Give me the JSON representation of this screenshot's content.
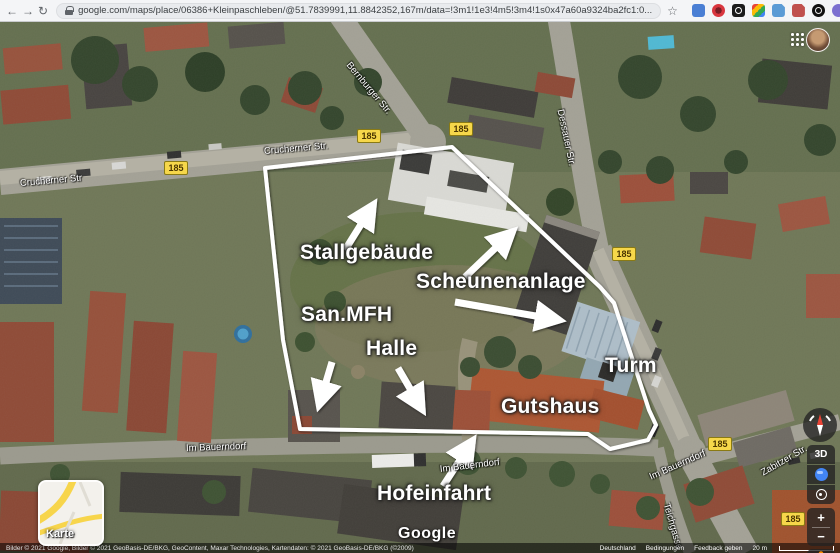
{
  "browser": {
    "url": "google.com/maps/place/06386+Kleinpaschleben/@51.7839991,11.8842352,167m/data=!3m1!1e3!4m5!3m4!1s0x47a60a9324ba2fc1:0..."
  },
  "map": {
    "annotations": [
      {
        "text": "Stallgebäude"
      },
      {
        "text": "Scheunenanlage"
      },
      {
        "text": "San.MFH"
      },
      {
        "text": "Halle"
      },
      {
        "text": "Turm"
      },
      {
        "text": "Gutshaus"
      },
      {
        "text": "Hofeinfahrt"
      }
    ],
    "streets": [
      {
        "text": "Crucherner Str"
      },
      {
        "text": "Crucherner Str."
      },
      {
        "text": "Bernburger Str."
      },
      {
        "text": "Dessauer Str."
      },
      {
        "text": "Im Bauerndorf"
      },
      {
        "text": "Im Bauerndorf"
      },
      {
        "text": "Im Bauerndorf"
      },
      {
        "text": "Zabitzer Str."
      },
      {
        "text": "Teichgasse"
      }
    ],
    "route_badges": [
      {
        "text": "185"
      },
      {
        "text": "185"
      },
      {
        "text": "185"
      },
      {
        "text": "185"
      },
      {
        "text": "185"
      },
      {
        "text": "185"
      }
    ],
    "controls": {
      "map_type_label": "Karte",
      "tilt_label": "3D"
    },
    "logo": "Google",
    "attribution": {
      "copyright": "Bilder © 2021 Google, Bilder © 2021 GeoBasis-DE/BKG, GeoContent, Maxar Technologies, Kartendaten: © 2021 GeoBasis-DE/BKG (©2009)",
      "country": "Deutschland",
      "terms": "Bedingungen",
      "feedback": "Feedback geben",
      "scale": "20 m"
    },
    "colors": {
      "route_badge": "#f6d74a",
      "boundary": "#ffffff",
      "pegman": "#fb8c00",
      "location_blue": "#4285f4"
    }
  }
}
